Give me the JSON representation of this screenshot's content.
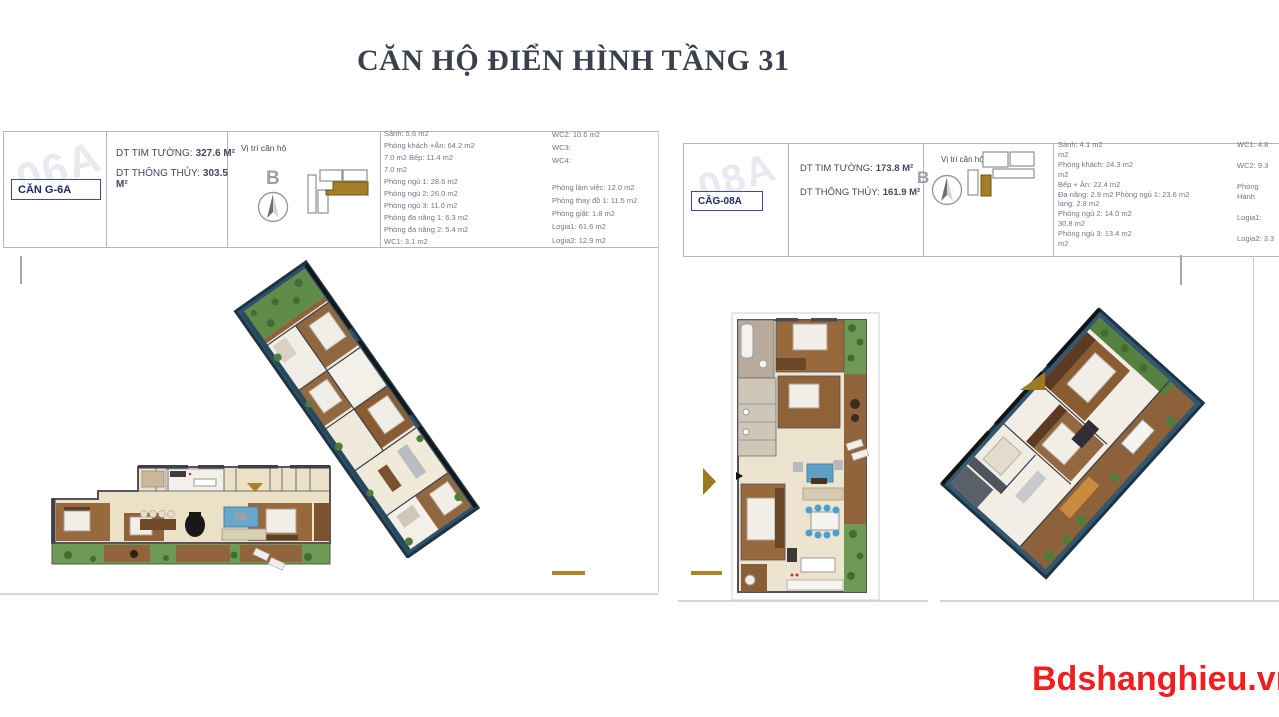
{
  "page": {
    "title": "CĂN HỘ ĐIỂN HÌNH TẦNG 31",
    "site_watermark": "Bdshanghieu.vn"
  },
  "colors": {
    "gold_accent": "#A8802A",
    "gold_dash": "#B08427",
    "label_blue": "#3B4A9E",
    "watermark_red": "#F01F1F",
    "table_border": "#B3B7BE",
    "title_text": "#3A404C",
    "room_text": "#6E7886",
    "header_text": "#3E4A5E",
    "plan_wall_navy": "#30536A",
    "plan_wood": "#97693D",
    "plan_green": "#6F9A55",
    "plan_floor": "#EAE1C6"
  },
  "left_unit": {
    "code_watermark": "06A",
    "unit_label": "CĂN G-6A",
    "area1_label": "DT TIM TƯỜNG:",
    "area1_value": "327.6 M²",
    "area2_label": "DT THÔNG THỦY:",
    "area2_value": "303.5 M²",
    "location_label": "Vị trí căn hộ",
    "compass_letter": "B",
    "rooms_col1": [
      "Sảnh: 5.6 m2",
      "Phòng khách +Ăn: 64.2 m2",
      "7.0 m2 Bếp: 11.4 m2",
      "7.0 m2",
      "Phòng ngủ 1: 28.6 m2",
      "Phòng ngủ 2: 26.0 m2",
      "Phòng ngủ 3: 11.0 m2",
      "Phòng đa năng 1: 6.3 m2",
      "Phòng đa năng 2: 5.4 m2",
      "WC1: 3.1 m2"
    ],
    "rooms_col2": [
      "WC2: 10.6 m2",
      "WC3:",
      "WC4:",
      "",
      "Phòng làm việc: 12.0 m2",
      "Phòng thay đồ 1: 11.5 m2",
      "Phòng giặt: 1.8 m2",
      "Logia1: 61.6 m2",
      "Logia2: 12.9 m2"
    ]
  },
  "right_unit": {
    "code_watermark": "08A",
    "unit_label": "CĂG-08A",
    "area1_label": "DT TIM TƯỜNG:",
    "area1_value": "173.8 M²",
    "area2_label": "DT THÔNG THỦY:",
    "area2_value": "161.9 M²",
    "location_label": "Vị trí căn hộ",
    "compass_letter": "B",
    "rooms_col1": [
      "Sảnh: 4.1 m2",
      "m2",
      "Phòng khách: 24.3 m2",
      "m2",
      "Bếp + Ăn: 22.4 m2",
      "Đa năng: 2.9 m2 Phòng ngủ 1: 23.6 m2",
      "lang: 2.8 m2",
      "Phòng ngủ 2: 14.0 m2",
      "30.8 m2",
      "Phòng ngủ 3: 13.4 m2",
      "m2"
    ],
    "rooms_col2": [
      "WC1: 4.8",
      "",
      "WC2: 9.3",
      "",
      "Phòng",
      "Hành",
      "",
      "Logia1:",
      "",
      "Logia2: 3.3"
    ]
  }
}
